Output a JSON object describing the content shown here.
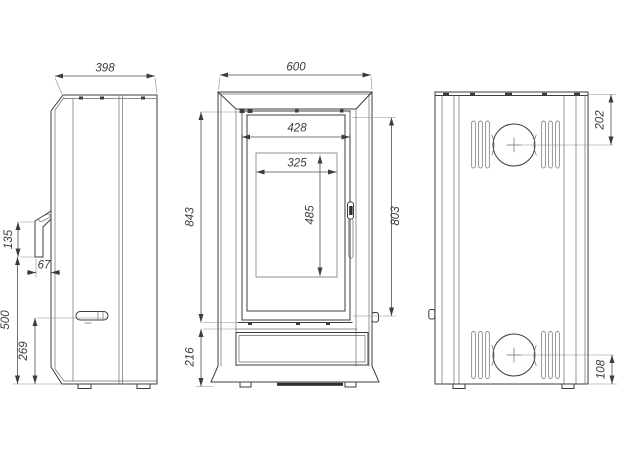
{
  "drawing": {
    "style": {
      "line_color": "#3c3c3c",
      "background": "#ffffff"
    },
    "views": {
      "side": {
        "dims": {
          "depth": "398",
          "bracket_height": "135",
          "bracket_depth": "67",
          "intake_bottom_height": "500",
          "handle_center_height": "269"
        }
      },
      "front": {
        "dims": {
          "width": "600",
          "glass_width": "428",
          "firebox_width": "325",
          "firebox_height": "485",
          "upper_section_height": "843",
          "door_glass_height": "803",
          "base_section_height": "216"
        }
      },
      "back": {
        "dims": {
          "flue_center_from_top": "202",
          "inlet_center_from_bottom": "108"
        }
      }
    }
  }
}
